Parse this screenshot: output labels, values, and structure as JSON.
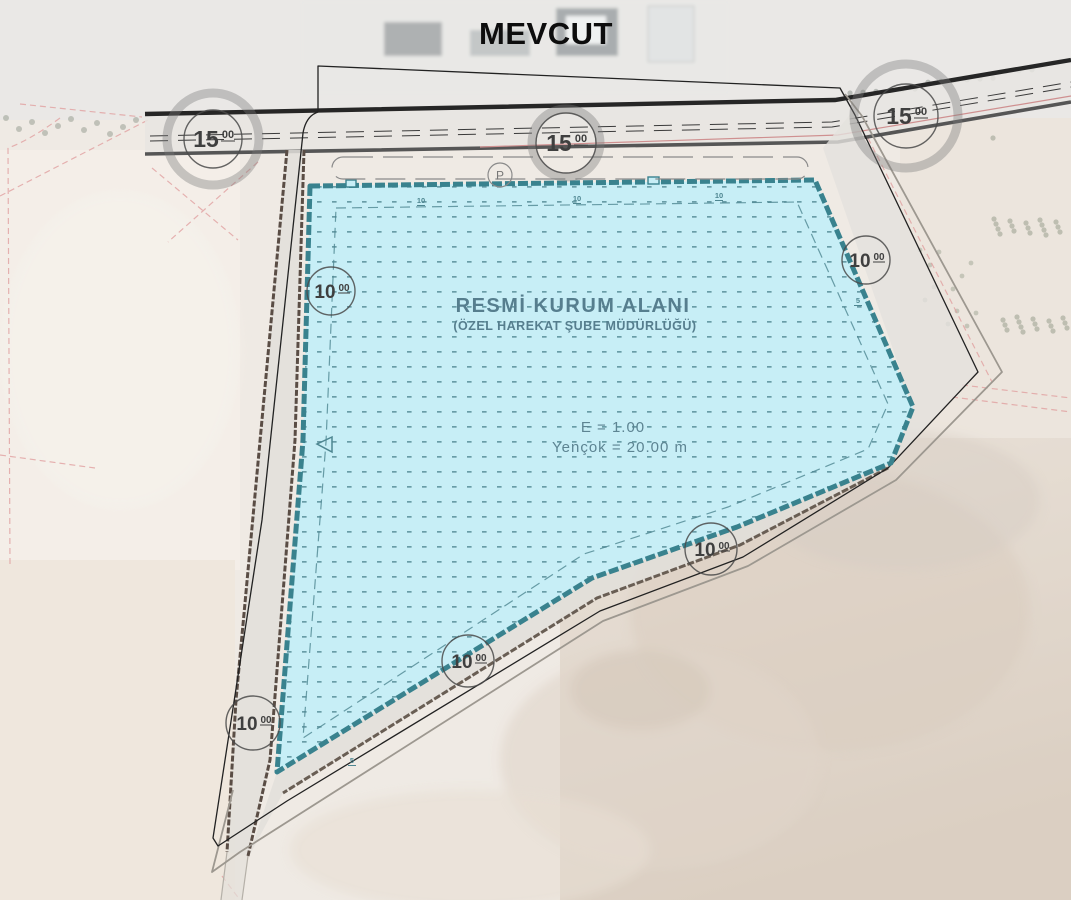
{
  "title": "MEVCUT",
  "zone": {
    "name": "RESMİ KURUM ALANI",
    "subtitle": "(ÖZEL HAREKAT ŞUBE MÜDÜRLÜĞÜ)",
    "far": "E = 1.00",
    "hmax": "Yençok = 20.00 m"
  },
  "parking_label": "P",
  "road_markers": [
    {
      "value": "15",
      "sup": "00",
      "x": 213,
      "y": 139,
      "r": 29,
      "ring": true,
      "ring_r": 46,
      "size": "large"
    },
    {
      "value": "15",
      "sup": "00",
      "x": 566,
      "y": 143,
      "r": 30,
      "ring": true,
      "ring_r": 34,
      "size": "large"
    },
    {
      "value": "15",
      "sup": "00",
      "x": 906,
      "y": 116,
      "r": 32,
      "ring": true,
      "ring_r": 52,
      "size": "large"
    },
    {
      "value": "10",
      "sup": "00",
      "x": 331,
      "y": 291,
      "r": 24,
      "ring": false,
      "size": "small"
    },
    {
      "value": "10",
      "sup": "00",
      "x": 866,
      "y": 260,
      "r": 24,
      "ring": false,
      "size": "small"
    },
    {
      "value": "10",
      "sup": "00",
      "x": 711,
      "y": 549,
      "r": 26,
      "ring": false,
      "size": "small"
    },
    {
      "value": "10",
      "sup": "00",
      "x": 468,
      "y": 661,
      "r": 26,
      "ring": false,
      "size": "small"
    },
    {
      "value": "10",
      "sup": "00",
      "x": 253,
      "y": 723,
      "r": 27,
      "ring": false,
      "size": "small"
    }
  ],
  "setback_ticks": [
    {
      "label": "10",
      "x": 421,
      "y": 203
    },
    {
      "label": "10",
      "x": 577,
      "y": 201
    },
    {
      "label": "10",
      "x": 719,
      "y": 198
    },
    {
      "label": "5",
      "x": 858,
      "y": 303
    },
    {
      "label": "5",
      "x": 352,
      "y": 763
    }
  ],
  "colors": {
    "zone_fill": "#c7eef6",
    "zone_border": "#39828e",
    "zone_text": "#567e8e",
    "title_color": "#0d0d0d"
  }
}
